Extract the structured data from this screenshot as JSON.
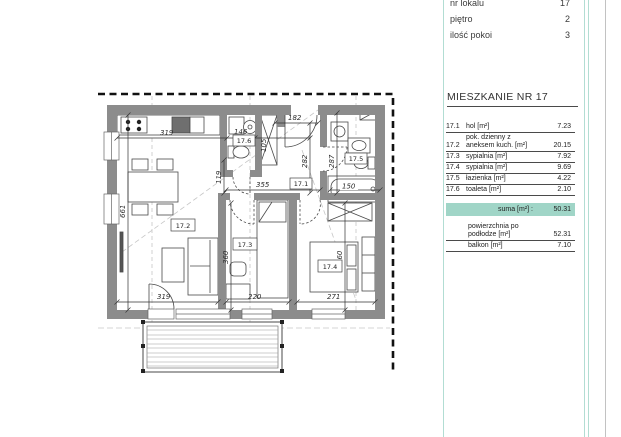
{
  "panel": {
    "info": [
      {
        "label": "nr lokalu",
        "value": "17"
      },
      {
        "label": "piętro",
        "value": "2"
      },
      {
        "label": "ilość pokoi",
        "value": "3"
      }
    ],
    "title": "MIESZKANIE NR 17",
    "rooms": [
      {
        "no": "17.1",
        "name": "hol [m²]",
        "area": "7.23"
      },
      {
        "no": "17.2",
        "name_line1": "pok. dzienny z",
        "name_line2": "aneksem kuch. [m²]",
        "area": "20.15"
      },
      {
        "no": "17.3",
        "name": "sypialnia [m²]",
        "area": "7.92"
      },
      {
        "no": "17.4",
        "name": "sypialnia [m²]",
        "area": "9.69"
      },
      {
        "no": "17.5",
        "name": "łazienka [m²]",
        "area": "4.22"
      },
      {
        "no": "17.6",
        "name": "toaleta [m²]",
        "area": "2.10"
      }
    ],
    "suma": {
      "label": "suma [m²] :",
      "value": "50.31"
    },
    "extra": [
      {
        "label_line1": "powierzchnia po",
        "label_line2": "podłodze [m²]",
        "value": "52.31"
      },
      {
        "label_line1": "balkon [m²]",
        "value": "7.10"
      }
    ]
  },
  "plan": {
    "room_labels": {
      "hall": "17.1",
      "living": "17.2",
      "bedroom_small": "17.3",
      "bedroom": "17.4",
      "bathroom": "17.5",
      "toilet": "17.6"
    },
    "dims": {
      "kitchen_width": "319",
      "toilet_width": "146",
      "closet_depth": "105",
      "entry_width": "182",
      "hall_depth": "282",
      "bath_depth": "287",
      "bathtub_length": "150",
      "living_depth": "661",
      "passage_width": "119",
      "hall_width": "355",
      "bedroom_small_depth": "360",
      "bedroom_small_width": "220",
      "bedroom_depth": "360",
      "bedroom_width": "271",
      "living_width": "319"
    }
  },
  "colors": {
    "teal_fill": "#a0d5c7",
    "teal_line": "#b2ddd3",
    "wall_gray": "#8c8c8c"
  }
}
